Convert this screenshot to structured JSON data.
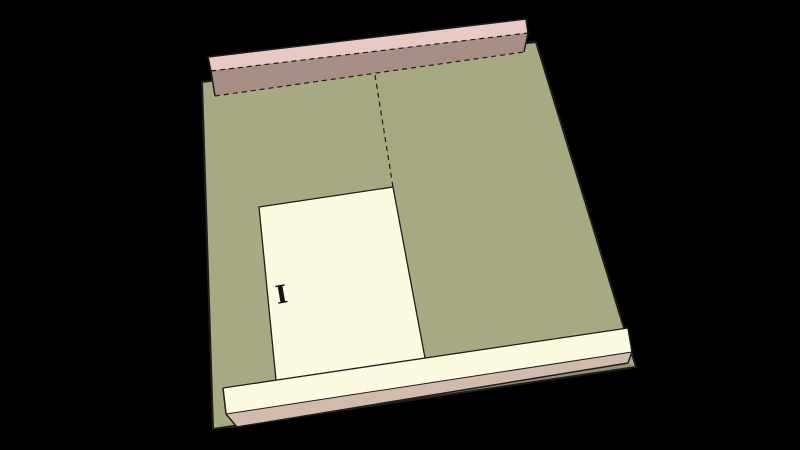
{
  "app": {
    "name": "3d-model-viewport",
    "background": "#000000",
    "description": "SketchUp-style 3D perspective view of a wall panel assembly lying nearly flat: large olive sheathing panel, pink lumber top plate beam along the upper edge, cream sill plate beam along the lower edge, cream door-opening cutout, dashed hidden edges, black background"
  },
  "scene": {
    "line_color": "#1e1e1e",
    "dash_pattern": "5,4",
    "colors": {
      "panel_olive": "#a7a981",
      "panel_edge_dark_olive": "#8e9270",
      "cutout_cream": "#fcfae1",
      "sill_underside_pink": "#d0bbac",
      "top_plate_pink": "#e8cac3",
      "top_plate_mauve": "#a78e86",
      "background_black": "#000000"
    },
    "layers": [
      {
        "name": "wall-panel",
        "polygons": [
          {
            "name": "panel-face",
            "fill": "#a7a981",
            "points": "202,82 536,42 636,367 213,429"
          },
          {
            "name": "panel-bottom-edge-strip",
            "fill": "#8e9270",
            "points": "237,427 628,363 636,367 213,429"
          }
        ],
        "lines": [
          {
            "name": "panel-outline",
            "type": "solid",
            "width": 2,
            "closed": true,
            "points": "202,82 536,42 636,367 213,429"
          }
        ]
      },
      {
        "name": "door-opening",
        "polygons": [
          {
            "name": "door-opening-face",
            "fill": "#fcfae1",
            "points": "259,207 393,187 425,358 276,380"
          }
        ],
        "lines": [
          {
            "name": "door-opening-edges",
            "type": "solid",
            "width": 1.3,
            "closed": false,
            "points": "276,380 259,207 393,187 425,358"
          },
          {
            "name": "panel-seam-hidden-edge",
            "type": "dashed",
            "width": 1.2,
            "closed": false,
            "points": "375,75 393,187"
          }
        ]
      },
      {
        "name": "sill-beam",
        "polygons": [
          {
            "name": "sill-beam-face",
            "fill": "#fcfae1",
            "points": "223,388 628,328 632,352 226,414"
          },
          {
            "name": "sill-beam-underside",
            "fill": "#d0bbac",
            "points": "226,414 632,352 628,363 237,427"
          }
        ],
        "lines": [
          {
            "name": "sill-beam-top-edge",
            "type": "solid",
            "width": 1.3,
            "closed": false,
            "points": "223,388 628,328"
          },
          {
            "name": "sill-beam-front-edge",
            "type": "solid",
            "width": 1,
            "closed": false,
            "points": "226,414 632,352"
          },
          {
            "name": "sill-beam-outline",
            "type": "solid",
            "width": 1.5,
            "closed": false,
            "points": "223,388 226,414 237,427 628,363 632,352 628,328"
          }
        ]
      },
      {
        "name": "top-plate-beam",
        "polygons": [
          {
            "name": "top-plate-top-face",
            "fill": "#e8cac3",
            "points": "208,57 526,19 528,33 211,71"
          },
          {
            "name": "top-plate-front-face",
            "fill": "#a78e86",
            "points": "211,71 528,33 524,52 215,96"
          }
        ],
        "lines": [
          {
            "name": "top-plate-outline",
            "type": "solid",
            "width": 1.5,
            "closed": false,
            "points": "215,96 211,71 208,57 526,19 528,33 524,52"
          },
          {
            "name": "top-plate-hidden-edge-upper",
            "type": "dashed",
            "width": 1.2,
            "closed": false,
            "points": "211,71 528,33"
          },
          {
            "name": "top-plate-hidden-edge-lower",
            "type": "dashed",
            "width": 1.2,
            "closed": false,
            "points": "215,96 524,52"
          }
        ]
      }
    ],
    "annotation": {
      "name": "annotation-glyph",
      "text": "I",
      "x": 283,
      "y": 303,
      "rotation": -10,
      "font_size": 25,
      "color": "#111111"
    }
  }
}
